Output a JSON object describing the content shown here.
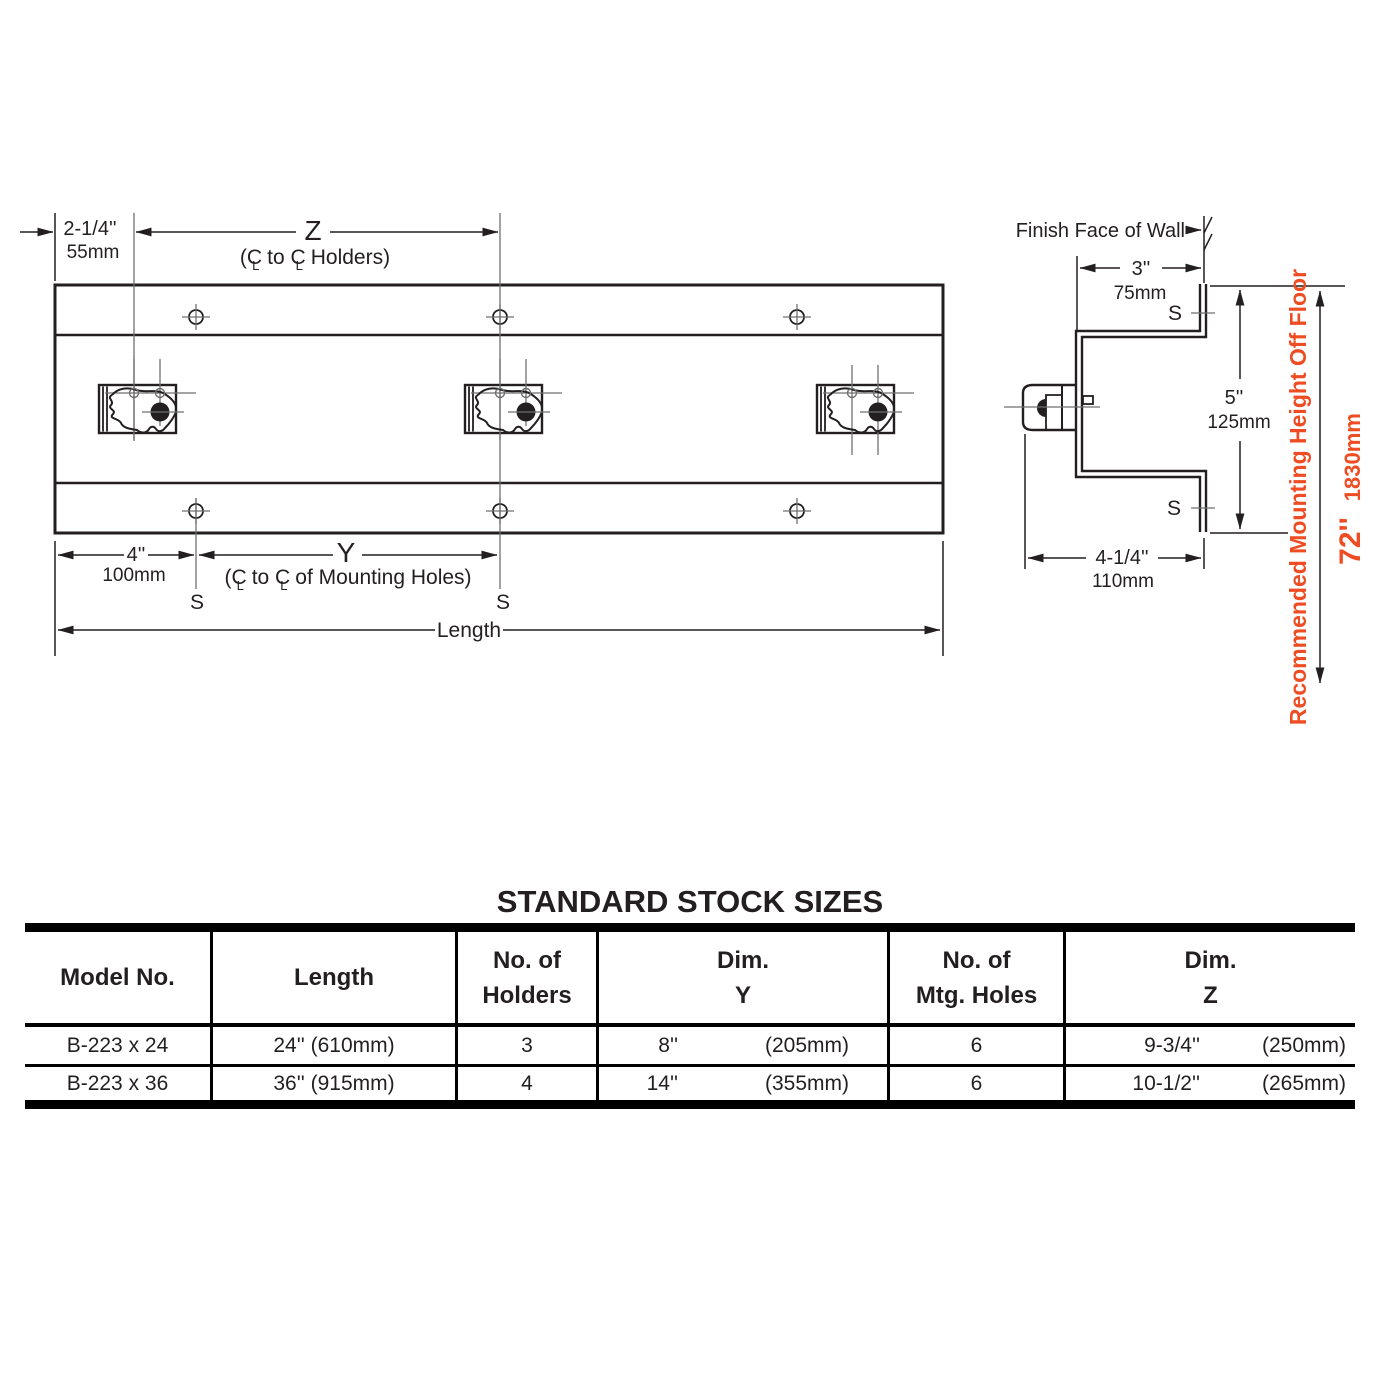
{
  "colors": {
    "accent": "#ee4c23",
    "line": "#231f20"
  },
  "diagram": {
    "front_view": {
      "offset_in": "2-1/4''",
      "offset_mm": "55mm",
      "z_label": "Z",
      "z_sub_parts": [
        "(C",
        "L",
        " to C",
        "L",
        " Holders)"
      ],
      "spacing_in": "4''",
      "spacing_mm": "100mm",
      "y_label": "Y",
      "y_sub_parts": [
        "(C",
        "L",
        " to C",
        "L",
        " of Mounting Holes)"
      ],
      "s_label": "S",
      "length_label": "Length"
    },
    "side_view": {
      "finish_face_label": "Finish Face of Wall",
      "depth_in": "3''",
      "depth_mm": "75mm",
      "height_in": "5''",
      "height_mm": "125mm",
      "proj_in": "4-1/4''",
      "proj_mm": "110mm",
      "s_label": "S",
      "mount_height_label": "Recommended Mounting Height Off Floor",
      "mount_height_in": "72''",
      "mount_height_mm": "1830mm"
    }
  },
  "table": {
    "title": "STANDARD STOCK SIZES",
    "headers": {
      "model": "Model No.",
      "length": "Length",
      "no_of": "No. of",
      "holders2": "Holders",
      "dim": "Dim.",
      "dim_y": "Y",
      "mtg2": "Mtg. Holes",
      "dim_z": "Z"
    },
    "rows": [
      {
        "model": "B-223 x 24",
        "length": "24'' (610mm)",
        "holders": "3",
        "y_in": "8''",
        "y_mm": "(205mm)",
        "mtg": "6",
        "z_in": "9-3/4''",
        "z_mm": "(250mm)"
      },
      {
        "model": "B-223 x 36",
        "length": "36'' (915mm)",
        "holders": "4",
        "y_in": "14''",
        "y_mm": "(355mm)",
        "mtg": "6",
        "z_in": "10-1/2''",
        "z_mm": "(265mm)"
      }
    ]
  }
}
